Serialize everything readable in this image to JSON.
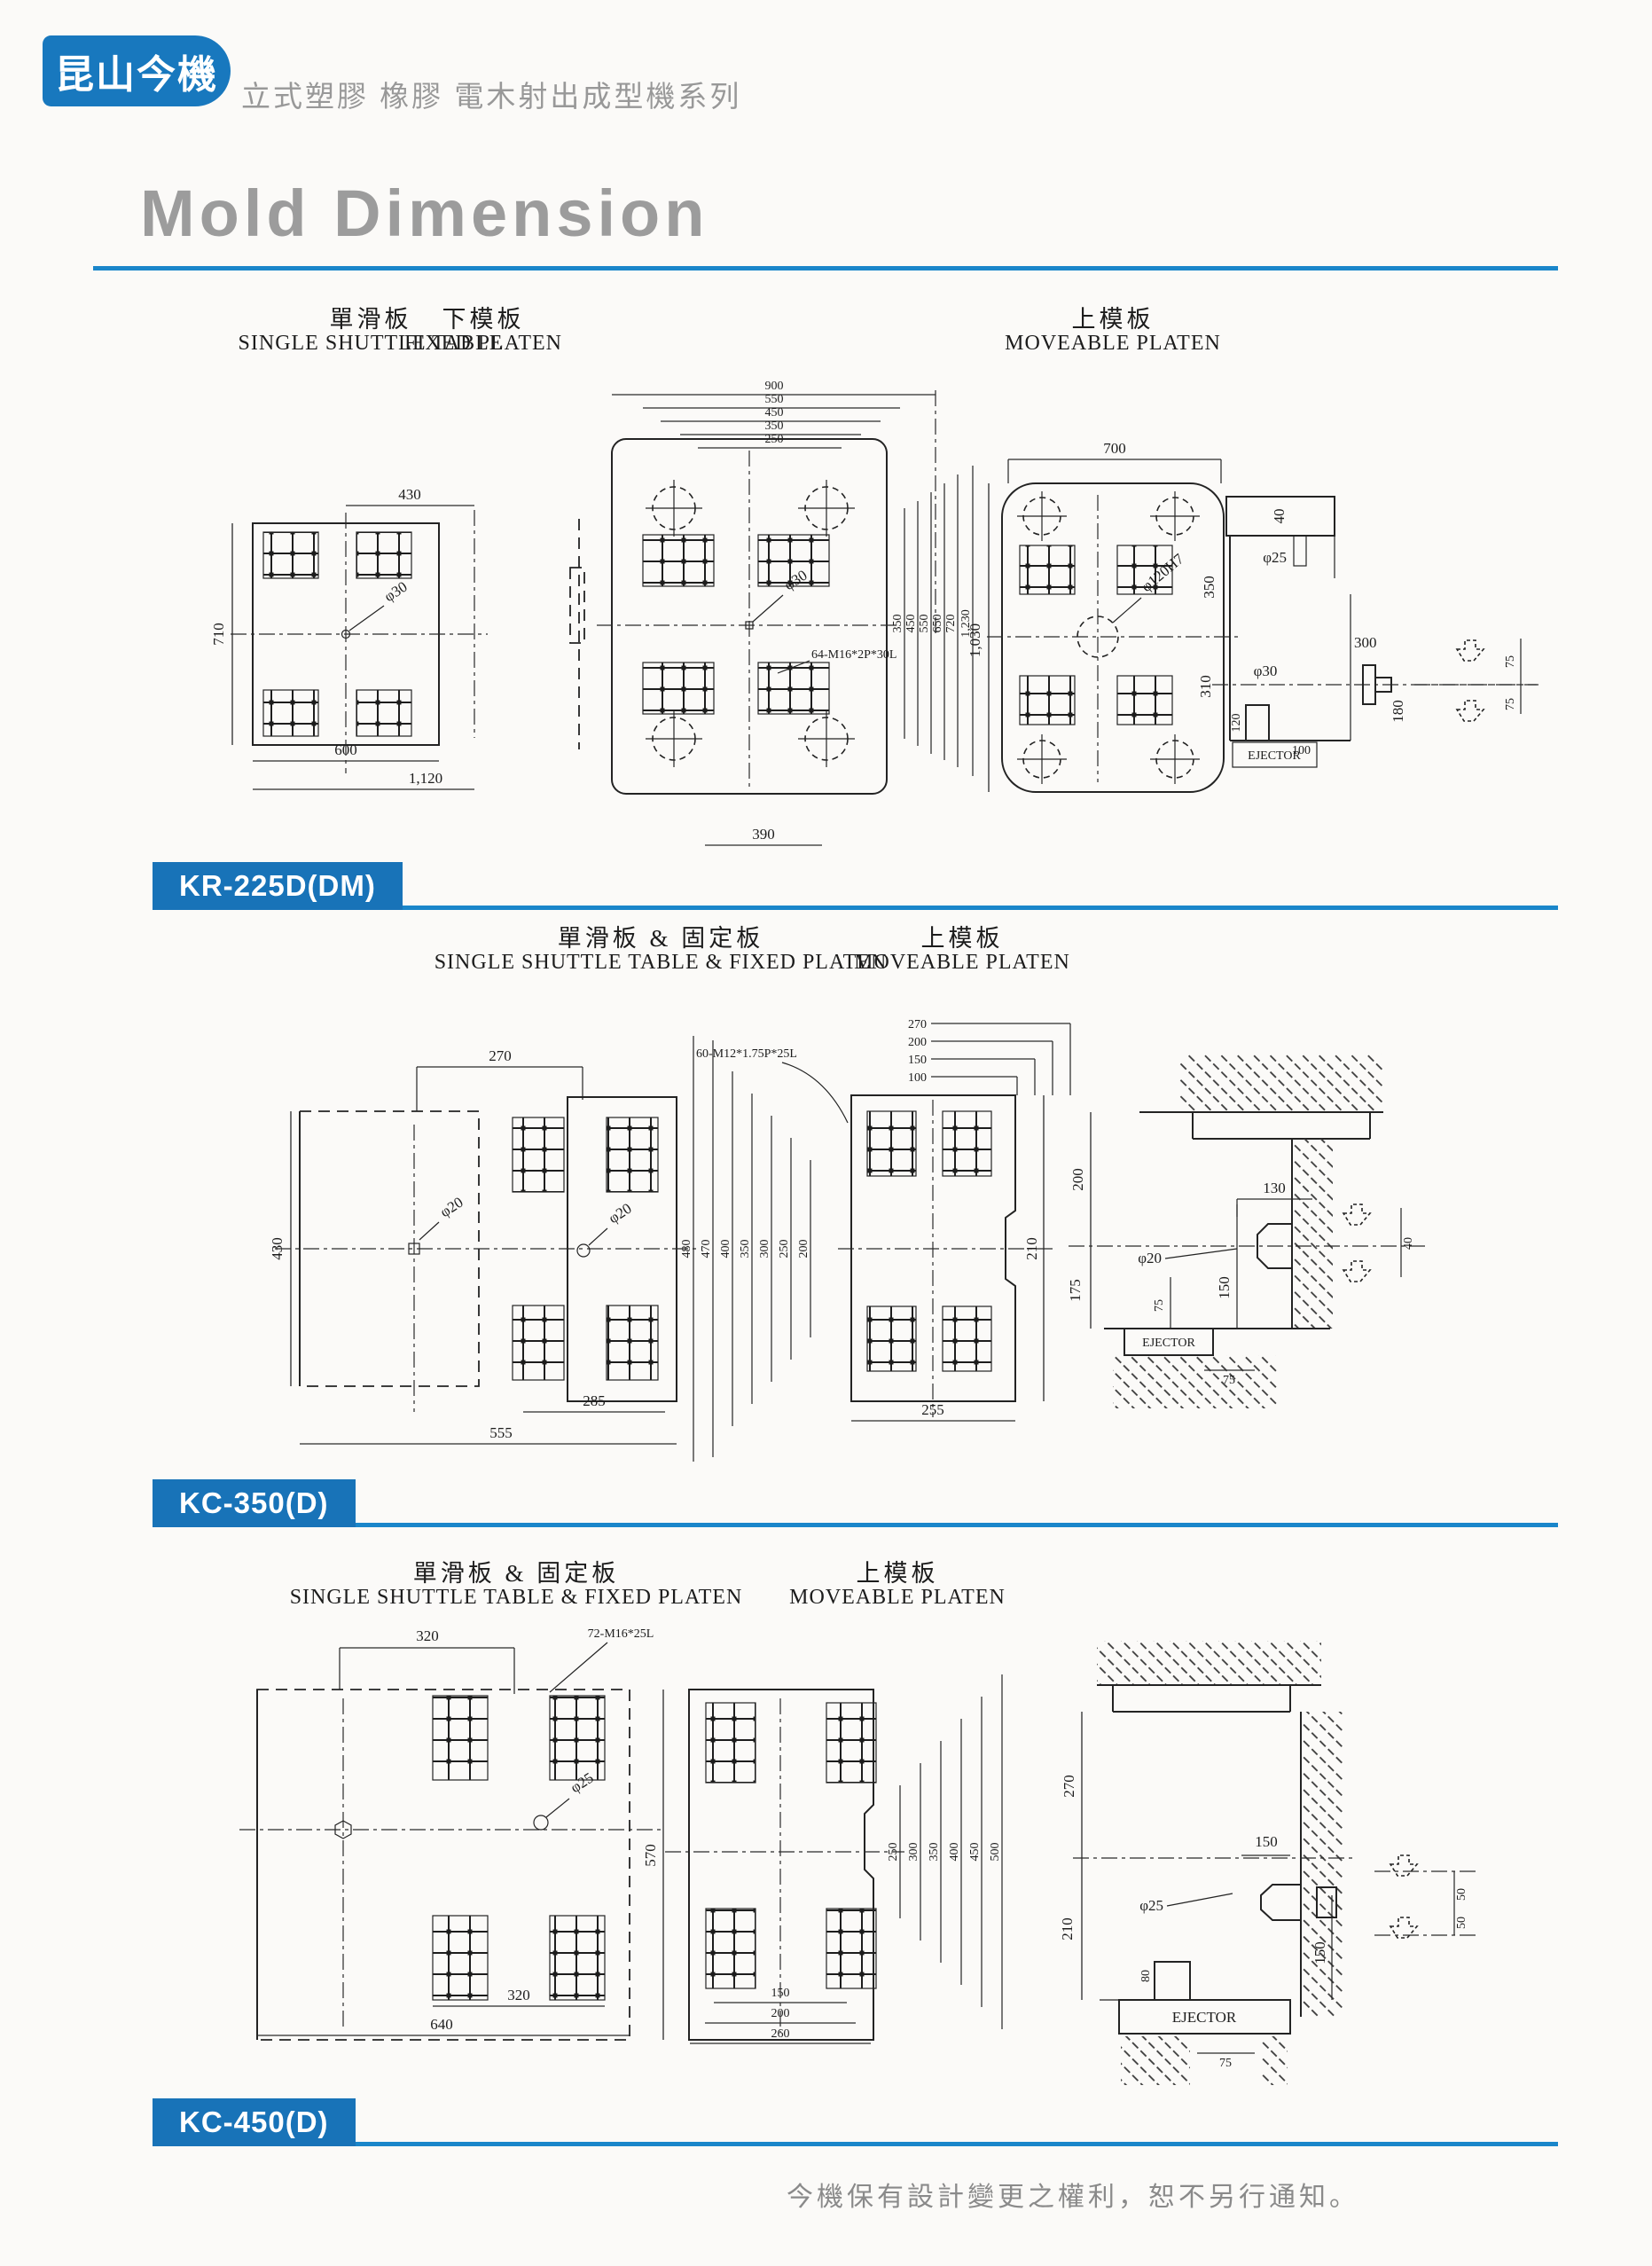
{
  "header": {
    "logo": "昆山今機",
    "series": "立式塑膠 橡膠 電木射出成型機系列"
  },
  "title": "Mold Dimension",
  "footer": "今機保有設計變更之權利，恕不另行通知。",
  "sections": [
    {
      "model": "KR-225D(DM)",
      "groups": [
        {
          "zh": "單滑板",
          "en": "SINGLE SHUTTLE TABLE",
          "dims": {
            "top": "430",
            "left": "710",
            "center": "φ30",
            "bottom1": "600",
            "bottom2": "1,120"
          }
        },
        {
          "zh": "下模板",
          "en": "FIXED PLATEN",
          "dims": {
            "w": [
              "900",
              "550",
              "450",
              "350",
              "250"
            ],
            "center": "φ30",
            "note": "64-M16*2P*30L",
            "h": [
              "350",
              "450",
              "550",
              "650",
              "720",
              "1,230"
            ],
            "bottom": "390"
          }
        },
        {
          "zh": "上模板",
          "en": "MOVEABLE PLATEN",
          "dims": {
            "top": "700",
            "left": "1,030",
            "center": "φ120H7"
          },
          "side": {
            "t40": "40",
            "d25": "φ25",
            "h350": "350",
            "h310": "310",
            "d30": "φ30",
            "h120": "120",
            "w100": "100",
            "w300": "300",
            "h180": "180",
            "ej": "EJECTOR",
            "c75a": "75",
            "c75b": "75"
          }
        }
      ]
    },
    {
      "model": "KC-350(D)",
      "groups": [
        {
          "zh": "單滑板 & 固定板",
          "en": "SINGLE SHUTTLE TABLE & FIXED PLATEN",
          "dims": {
            "top": "270",
            "left": "430",
            "cl": "φ20",
            "cr": "φ20",
            "note": "60-M12*1.75P*25L",
            "h": [
              "480",
              "470",
              "400",
              "350",
              "300",
              "250",
              "200"
            ],
            "bottom1": "285",
            "bottom2": "555"
          }
        },
        {
          "zh": "上模板",
          "en": "MOVEABLE PLATEN",
          "dims": {
            "r": [
              "270",
              "200",
              "150",
              "100"
            ],
            "bottom": "255",
            "right": "210"
          }
        },
        {
          "side": {
            "h200": "200",
            "h175": "175",
            "t130": "130",
            "d20": "φ20",
            "s150": "150",
            "p75": "75",
            "b75": "75",
            "r40": "40",
            "ej": "EJECTOR"
          }
        }
      ]
    },
    {
      "model": "KC-450(D)",
      "groups": [
        {
          "zh": "單滑板 & 固定板",
          "en": "SINGLE SHUTTLE TABLE & FIXED PLATEN",
          "dims": {
            "top": "320",
            "note": "72-M16*25L",
            "center": "φ25",
            "bottom1": "320",
            "bottom2": "640"
          }
        },
        {
          "zh": "上模板",
          "en": "MOVEABLE PLATEN",
          "dims": {
            "left": "570",
            "h": [
              "250",
              "300",
              "350",
              "400",
              "450",
              "500"
            ],
            "b": [
              "150",
              "200",
              "260"
            ]
          }
        },
        {
          "side": {
            "h270": "270",
            "h210": "210",
            "d25": "φ25",
            "t150": "150",
            "s150": "150",
            "b80": "80",
            "b75": "75",
            "ej": "EJECTOR",
            "c50a": "50",
            "c50b": "50"
          }
        }
      ]
    }
  ]
}
